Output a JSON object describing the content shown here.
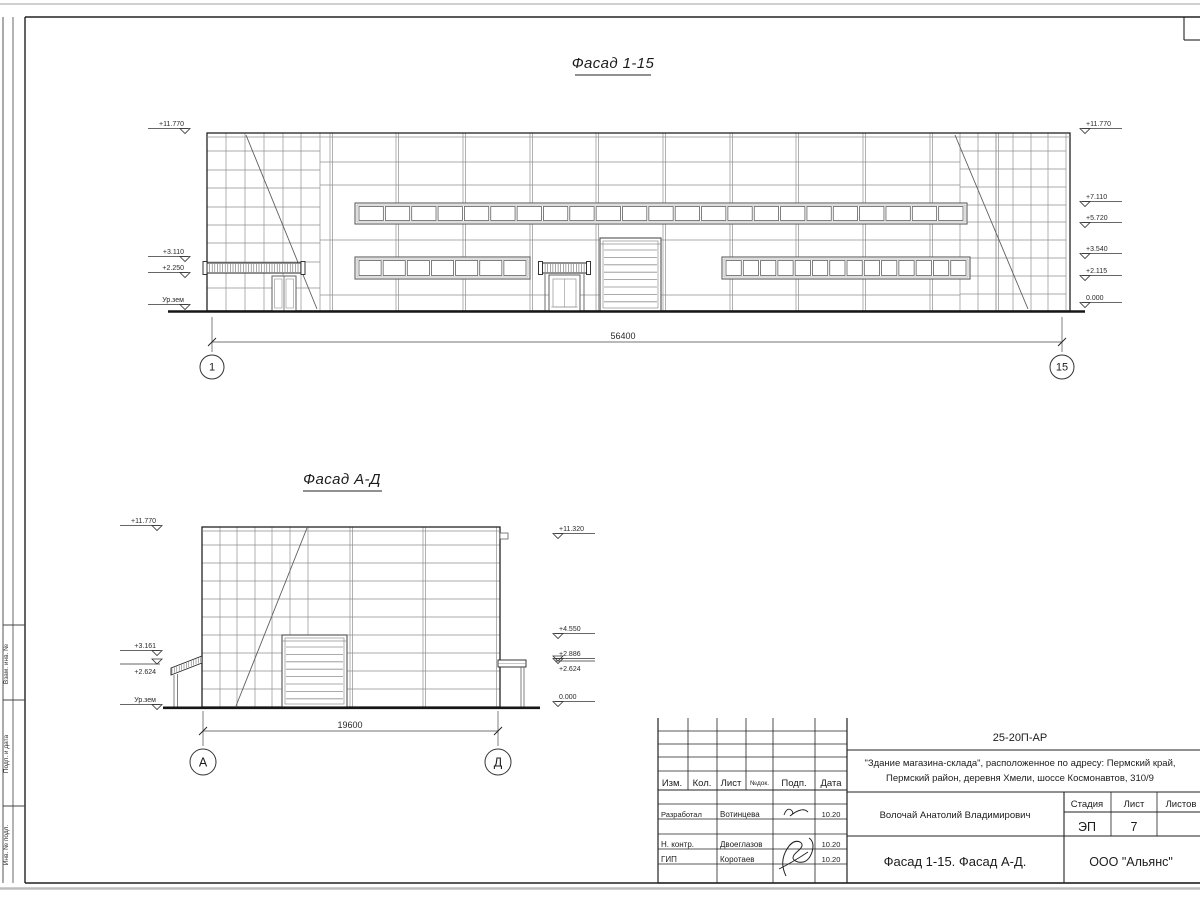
{
  "palette": {
    "paper": "#ffffff",
    "frame": "#222222",
    "grid_line": "#8f8f8f",
    "text": "#1c1c1c"
  },
  "facade1": {
    "title": "Фасад 1-15",
    "dimension": "56400",
    "axis_start": "1",
    "axis_end": "15",
    "marks_left": [
      "+11.770",
      "+3.110",
      "+2.250",
      "Ур.зем"
    ],
    "marks_right": [
      "+11.770",
      "+7.110",
      "+5.720",
      "+3.540",
      "+2.115",
      "0.000"
    ]
  },
  "facade2": {
    "title": "Фасад А-Д",
    "dimension": "19600",
    "axis_start": "А",
    "axis_end": "Д",
    "marks_left": [
      "+11.770",
      "+3.161",
      "+2.624",
      "Ур.зем"
    ],
    "marks_right": [
      "+11.320",
      "+4.550",
      "+2.886",
      "+2.624",
      "0.000"
    ]
  },
  "titleblock": {
    "doc_number": "25-20П-АР",
    "project_line1": "\"Здание магазина-склада\", расположенное по адресу: Пермский край,",
    "project_line2": "Пермский район, деревня Хмели, шоссе Космонавтов, 310/9",
    "col_izm": "Изм.",
    "col_kol": "Кол.",
    "col_list": "Лист",
    "col_ndok": "№док.",
    "col_podp": "Подп.",
    "col_data": "Дата",
    "role_developed": "Разработал",
    "name_developed": "Вотинцева",
    "date_developed": "10.20",
    "role_ncontrol": "Н. контр.",
    "name_ncontrol": "Двоеглазов",
    "date_ncontrol": "10.20",
    "role_gip": "ГИП",
    "name_gip": "Коротаев",
    "date_gip": "10.20",
    "author": "Волочай Анатолий Владимирович",
    "stage_label": "Стадия",
    "sheet_label": "Лист",
    "sheets_label": "Листов",
    "stage_value": "ЭП",
    "sheet_value": "7",
    "drawing_name": "Фасад 1-15. Фасад А-Д.",
    "company": "ООО \"Альянс\""
  },
  "side_column": {
    "label_top": "Взам. инв. №",
    "label_mid": "Подп. и дата",
    "label_bottom": "Инв. № подл."
  }
}
